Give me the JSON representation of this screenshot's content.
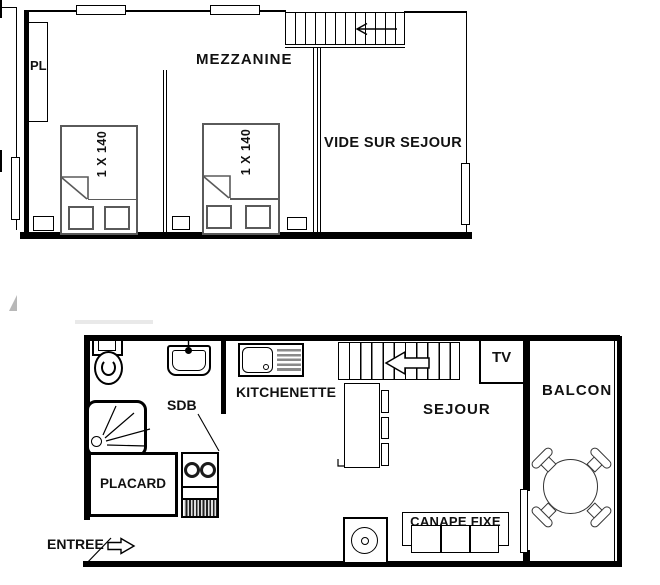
{
  "plan": {
    "upper": {
      "room_label": "MEZZANINE",
      "closet_label": "PL",
      "void_label": "VIDE SUR SEJOUR",
      "beds": [
        {
          "label": "1 X 140"
        },
        {
          "label": "1 X 140"
        }
      ]
    },
    "lower": {
      "kitchenette_label": "KITCHENETTE",
      "bathroom_label": "SDB",
      "closet_label": "PLACARD",
      "entrance_label": "ENTREE",
      "living_label": "SEJOUR",
      "tv_label": "TV",
      "balcony_label": "BALCON",
      "sofa_label": "CANAPE FIXE"
    },
    "colors": {
      "ink": "#000000",
      "furniture_gray": "#5a5a5a",
      "drainer_gray": "#8a8a8a"
    }
  }
}
